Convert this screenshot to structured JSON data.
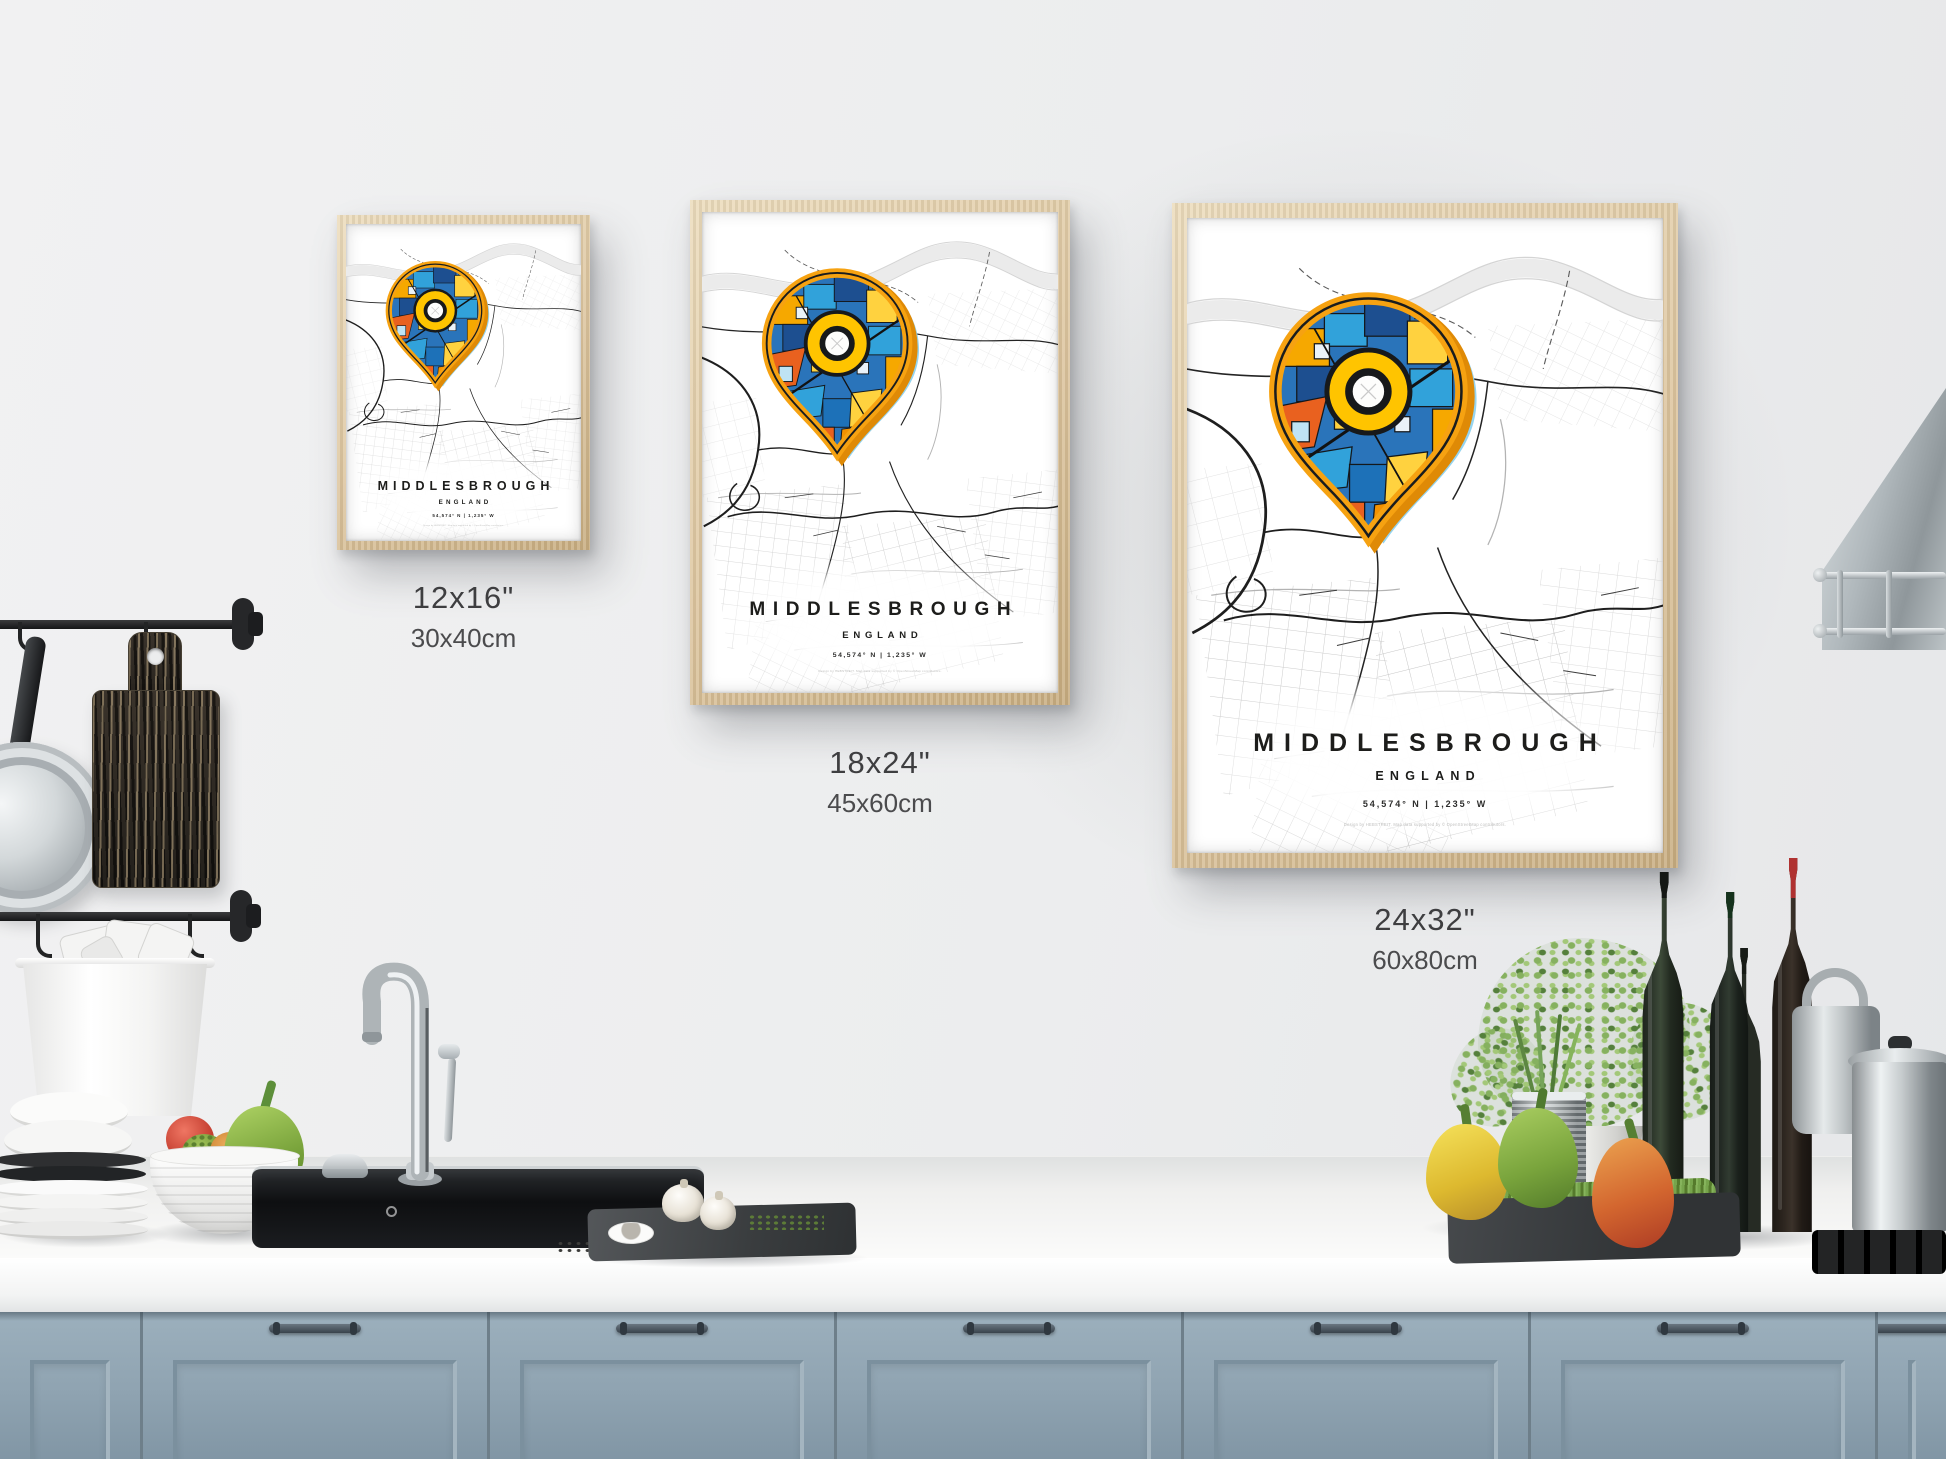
{
  "posters": [
    {
      "title": "MIDDLESBROUGH",
      "region": "ENGLAND",
      "coordinates": "54,574° N | 1,235° W",
      "credit": "Design by HEBSTREIT. Map data supported by © OpenStreetMap contributors.",
      "size_in": "12x16\"",
      "size_cm": "30x40cm"
    },
    {
      "title": "MIDDLESBROUGH",
      "region": "ENGLAND",
      "coordinates": "54,574° N | 1,235° W",
      "credit": "Design by HEBSTREIT. Map data supported by © OpenStreetMap contributors.",
      "size_in": "18x24\"",
      "size_cm": "45x60cm"
    },
    {
      "title": "MIDDLESBROUGH",
      "region": "ENGLAND",
      "coordinates": "54,574° N | 1,235° W",
      "credit": "Design by HEBSTREIT. Map data supported by © OpenStreetMap contributors.",
      "size_in": "24x32\"",
      "size_cm": "60x80cm"
    }
  ],
  "colors": {
    "wall": "#ecedee",
    "cabinet": "#8fa3b1",
    "counter": "#f4f4f3",
    "frame_wood": "#dcc49d",
    "pin_orange": "#f6a211",
    "pin_blue": "#2a74ba",
    "pin_yellow": "#ffc400",
    "halo_blue": "#8fd2ee",
    "label_text": "#3e3e40"
  }
}
